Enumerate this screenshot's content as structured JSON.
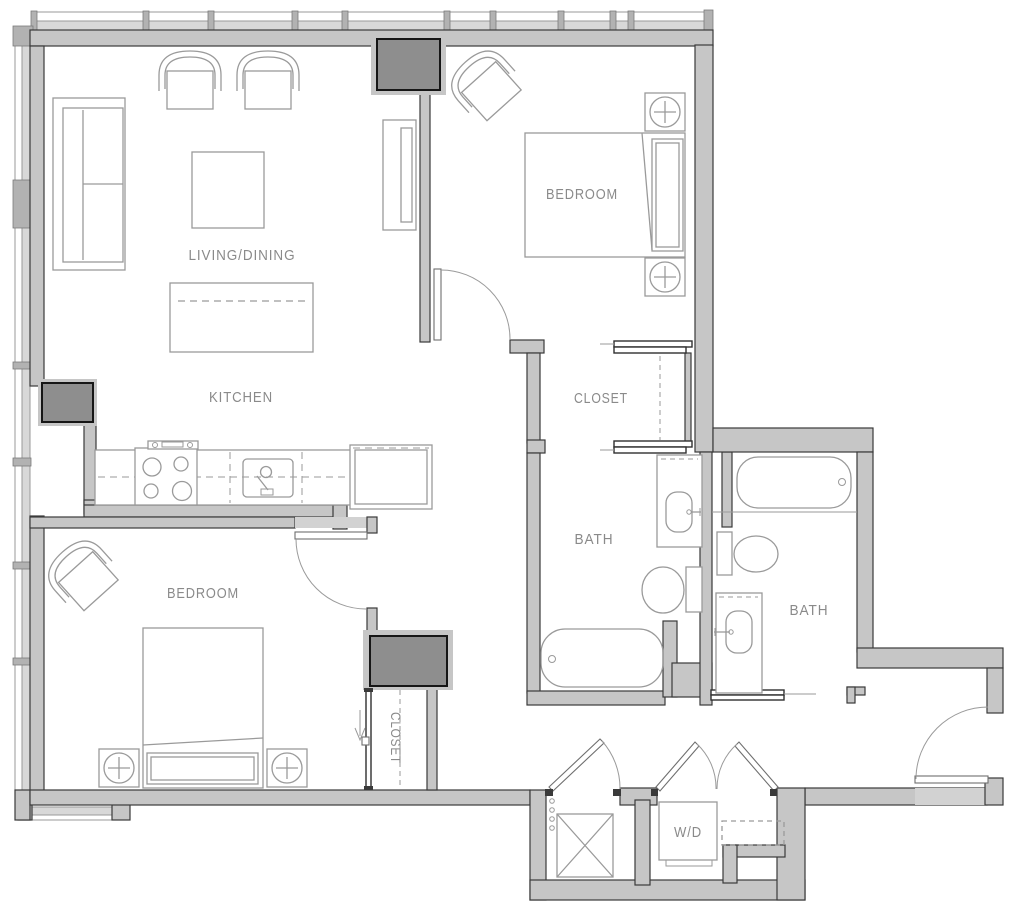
{
  "colors": {
    "wall": "#c6c6c6",
    "wall_dark": "#8e8e8e",
    "line": "#3a3a3a",
    "furniture_line": "#9a9a9a",
    "label": "#8a8a8a",
    "window_glass": "#d8d8d8",
    "door_header": "#d2d2d2",
    "background": "#ffffff"
  },
  "rooms": {
    "living_dining": {
      "label": "LIVING/DINING"
    },
    "kitchen": {
      "label": "KITCHEN"
    },
    "bedroom_top": {
      "label": "BEDROOM"
    },
    "closet_top": {
      "label": "CLOSET"
    },
    "bath_main": {
      "label": "BATH"
    },
    "bath_second": {
      "label": "BATH"
    },
    "bedroom_lower": {
      "label": "BEDROOM"
    },
    "closet_lower": {
      "label": "CLOSET"
    },
    "laundry": {
      "label": "W/D"
    }
  },
  "fixtures": [
    "sofa-icon",
    "armchair-icon",
    "coffee-table-icon",
    "dining-table-icon",
    "sideboard-icon",
    "range-icon",
    "sink-icon",
    "refrigerator-icon",
    "bed-icon",
    "nightstand-lamp-icon",
    "bathtub-icon",
    "toilet-icon",
    "vanity-sink-icon",
    "washer-dryer-icon",
    "door-swing-icon",
    "sliding-door-icon",
    "window-icon",
    "column-icon",
    "shelf-unit-icon",
    "entry-arrow-icon"
  ]
}
